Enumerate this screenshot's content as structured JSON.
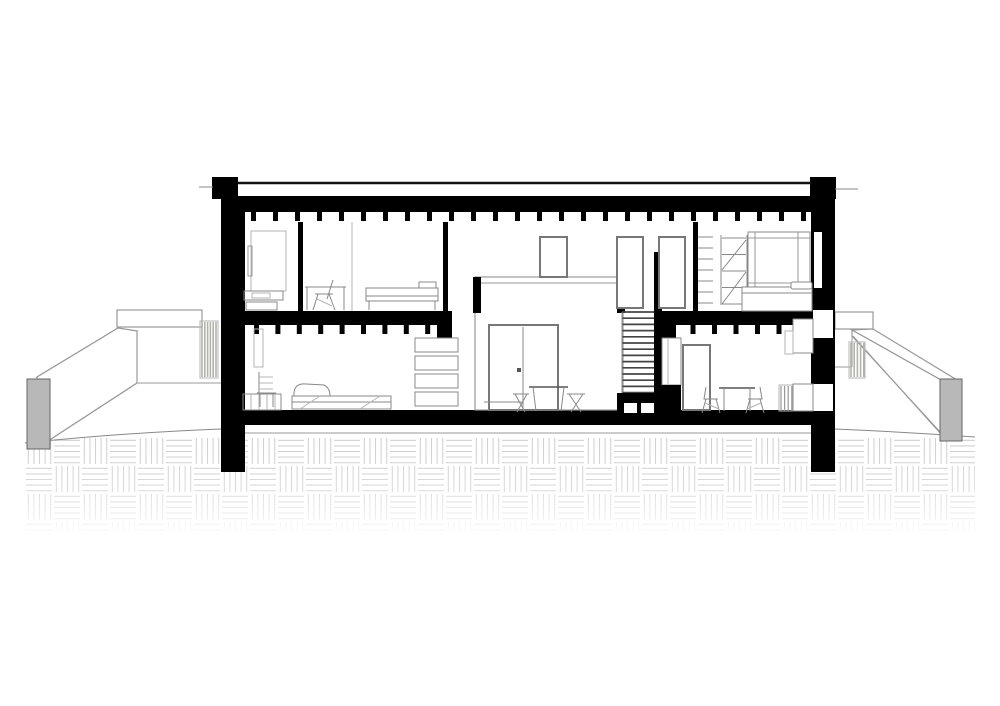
{
  "drawing_type": "architectural-cross-section",
  "colors": {
    "ink": "#000000",
    "mid": "#555555",
    "line": "#888888",
    "light": "#999999",
    "faint": "#b5b5b5",
    "hatch": "#cfcfcf",
    "post": "#b8b8b8",
    "paper": "#ffffff"
  },
  "structure": {
    "stories": 2,
    "roof_joist_count": 26,
    "upper_floor_joist_count_left": 10,
    "upper_floor_joist_count_right": 7,
    "stair_tread_count": 14,
    "wall_shelf_count": 4,
    "upper_doors_count": 3
  },
  "repeats": {
    "roof_joists": {
      "type": "rect",
      "x": 251,
      "y": 212,
      "w": 5,
      "h": 9,
      "count": 26,
      "dx": 22
    },
    "floor_joists_left": {
      "type": "rect",
      "x": 254,
      "y": 325,
      "w": 5,
      "h": 9,
      "count": 10,
      "dx": 21.4
    },
    "floor_joists_right": {
      "type": "rect",
      "x": 669,
      "y": 325,
      "w": 5,
      "h": 9,
      "count": 7,
      "dx": 21.5
    },
    "stair_treads": {
      "type": "line",
      "x1": 622,
      "y1": 312,
      "x2": 654,
      "y2": 312,
      "count": 14,
      "dy": 6.2
    },
    "screen_left": {
      "type": "line",
      "x1": 202,
      "y1": 322,
      "x2": 202,
      "y2": 377,
      "count": 6,
      "dx": 2.8
    },
    "screen_right": {
      "type": "line",
      "x1": 851,
      "y1": 343,
      "x2": 851,
      "y2": 377,
      "count": 5,
      "dx": 3.2
    },
    "radiator_fins": {
      "type": "line",
      "x1": 781,
      "y1": 386,
      "x2": 781,
      "y2": 411,
      "count": 4,
      "dx": 3.6
    },
    "bookshelf_lines": {
      "type": "line",
      "x1": 698,
      "y1": 237,
      "x2": 713,
      "y2": 237,
      "count": 7,
      "dy": 11
    },
    "ladder_rungs": {
      "type": "line",
      "x1": 722,
      "y1": 238,
      "x2": 746,
      "y2": 238,
      "count": 5,
      "dy": 16.5
    },
    "wall_shelf_boxes": {
      "type": "rect",
      "x": 415,
      "y": 338,
      "w": 43,
      "h": 14,
      "count": 4,
      "dy": 18
    },
    "stair_base_vents": {
      "type": "rect",
      "x": 624,
      "y": 403,
      "w": 13,
      "h": 10,
      "count": 2,
      "dx": 17
    }
  }
}
